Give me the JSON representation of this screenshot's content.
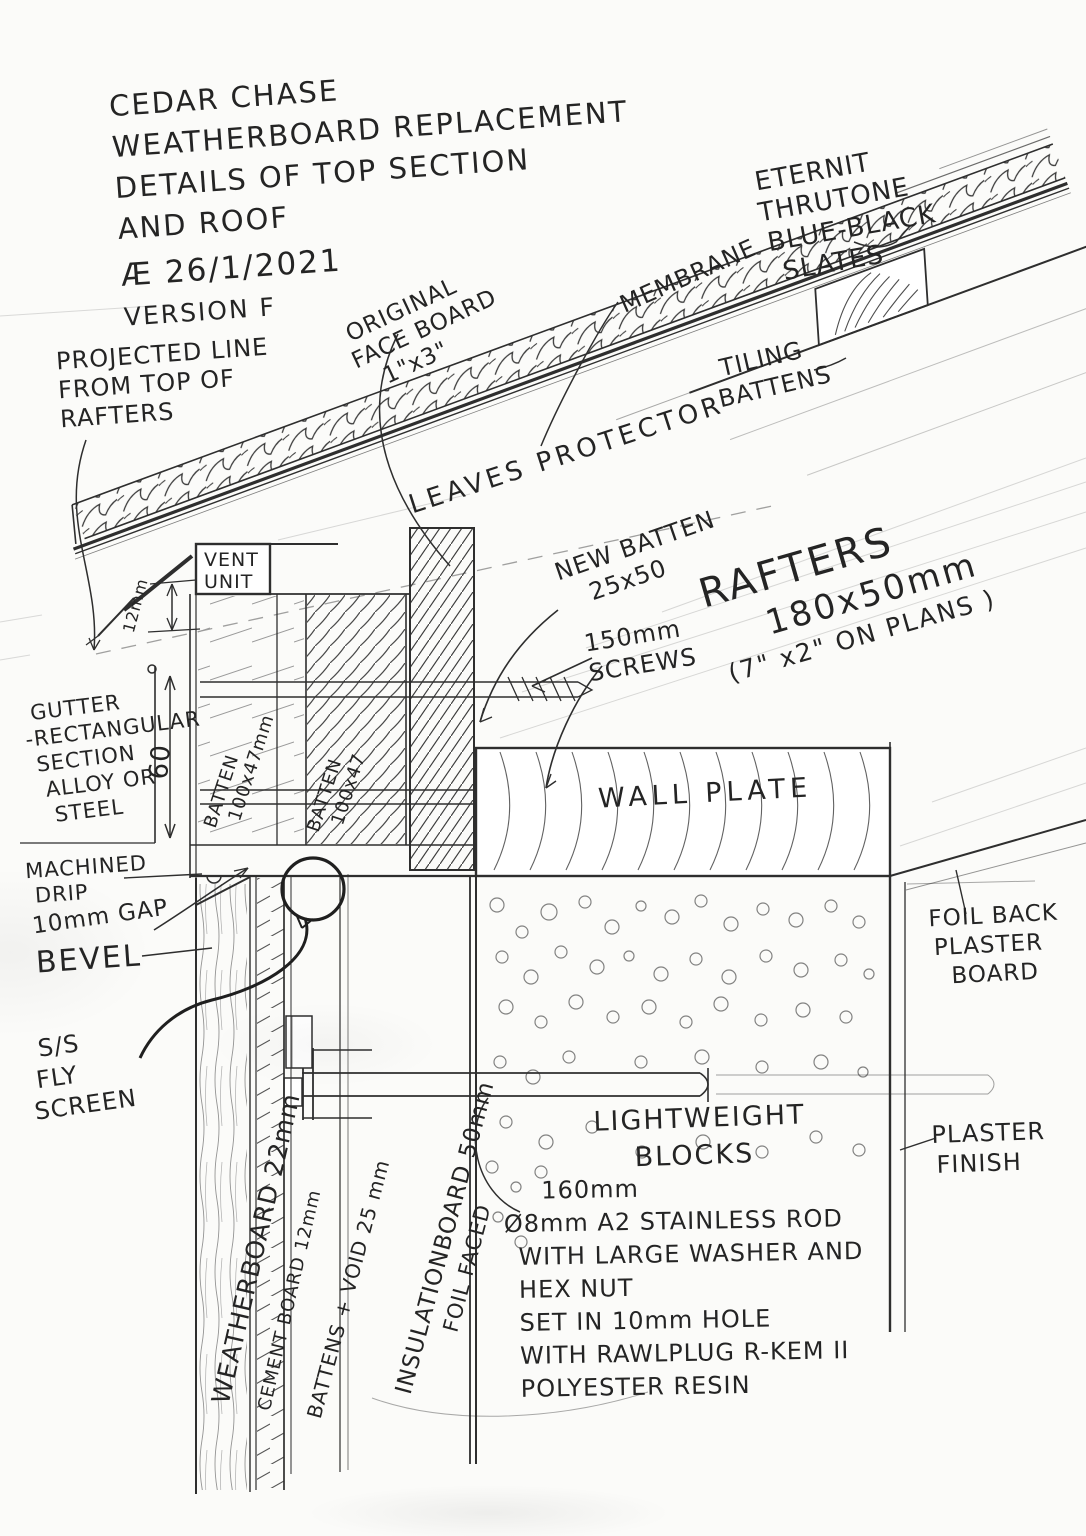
{
  "colors": {
    "pencil": "#2e2e2e",
    "pencil_faint": "#8a8a8a",
    "paper": "#fbfbf9"
  },
  "title": {
    "lines": [
      "CEDAR CHASE",
      "WEATHERBOARD REPLACEMENT",
      "DETAILS OF TOP SECTION",
      "AND ROOF"
    ],
    "date": "Æ 26/1/2021",
    "version": "VERSION F"
  },
  "labels": {
    "projected_line": [
      "PROJECTED LINE",
      "FROM TOP OF",
      "RAFTERS"
    ],
    "original_face_board": [
      "ORIGINAL",
      "FACE BOARD",
      "1\"x3\""
    ],
    "membrane": "MEMBRANE",
    "eternit": [
      "ETERNIT",
      "THRUTONE",
      "BLUE-BLACK",
      "SLATES"
    ],
    "tiling_battens": [
      "TILING",
      "BATTENS"
    ],
    "leaves_protector": "LEAVES PROTECTOR",
    "vent_unit": [
      "VENT",
      "UNIT"
    ],
    "new_batten": [
      "NEW BATTEN",
      "25x50"
    ],
    "screws_150": [
      "150mm",
      "SCREWS"
    ],
    "rafters": [
      "RAFTERS",
      "180x50mm",
      "(7\" x2\" ON PLANS )"
    ],
    "dim_12mm": "12mm",
    "dim_60": "60",
    "gutter": [
      "GUTTER",
      "-RECTANGULAR",
      "SECTION",
      "ALLOY OR",
      "STEEL"
    ],
    "batten_1": [
      "BATTEN",
      "100x47mm"
    ],
    "batten_2": [
      "BATTEN",
      "100x47"
    ],
    "wall_plate": "WALL PLATE",
    "machined_drip": [
      "MACHINED",
      "DRIP"
    ],
    "gap_10mm": "10mm GAP",
    "bevel": "BEVEL",
    "fly_screen": [
      "S/S",
      "FLY",
      "SCREEN"
    ],
    "foil_back_plasterboard": [
      "FOIL BACK",
      "PLASTER",
      "BOARD"
    ],
    "lightweight_blocks": [
      "LIGHTWEIGHT",
      "BLOCKS"
    ],
    "plaster_finish": [
      "PLASTER",
      "FINISH"
    ],
    "rod_note": [
      "160mm",
      "Ø8mm A2 STAINLESS ROD",
      "WITH LARGE WASHER AND",
      "HEX NUT",
      "SET IN 10mm HOLE",
      "WITH RAWLPLUG R-KEM II",
      "POLYESTER RESIN"
    ],
    "weatherboard": "WEATHERBOARD 22mm",
    "cement_board": "CEMENT BOARD 12mm",
    "battens_void": "BATTENS + VOID 25 mm",
    "insulation": [
      "INSULATIONBOARD 50mm",
      "FOIL FACED"
    ]
  }
}
